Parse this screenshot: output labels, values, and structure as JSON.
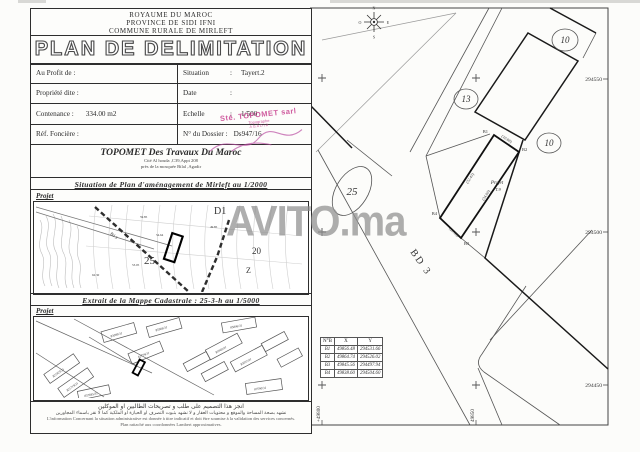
{
  "document": {
    "header": {
      "line1": "ROYAUME DU MAROC",
      "line2": "PROVINCE DE SIDI IFNI",
      "line3": "COMMUNE RURALE DE MIRLEFT"
    },
    "title": "PLAN DE DELIMITATION",
    "form": {
      "au_profit_label": "Au Profit de :",
      "propriete_label": "Propriété dite :",
      "contenance_label": "Contenance :",
      "contenance_value": "334.00 m2",
      "ref_fonciere_label": "Réf. Foncière :",
      "situation_label": "Situation",
      "situation_value": "Tayert.2",
      "date_label": "Date",
      "echelle_label": "Echelle",
      "echelle_value": "1/500",
      "dossier_label": "N° du Dossier :",
      "dossier_value": "Ds947/16",
      "colon": ":"
    },
    "firm": {
      "name": "TOPOMET Des Travaux Du Maroc",
      "address1": "Cité Al houda ,C39,Appt 208",
      "address2": "près de la mosquée Bilal ,Agadir"
    },
    "stamp": {
      "line1": "Sté. TOPOMET sarl",
      "line2": "Topographe",
      "line3": "AGADIR"
    },
    "sections": {
      "situation_title": "Situation de Plan d'aménagement de Mirleft au 1/2000",
      "cadastre_title": "Extrait de la Mappe Cadastrale : 25-3-h au 1/5000",
      "projet_label": "Projet"
    },
    "footer": {
      "arabic1": "انجز هذا التصميم على طلب و تصريحات الطالبين او الموكلين",
      "arabic2": "نشهد بصحة المساحة والموقع و محتويات العقار و لا نشهد بثبوت التصرف او الحيازة او الملكية كما لا نقر باسماء المجاورين",
      "french1": "L'information Concernant la situation administrative est donnée à titre indicatif et doit être soumise à la validation des services concernés.",
      "french2": "Plan rattaché aux coordonnées Lambert approximatives."
    }
  },
  "map1": {
    "labels": {
      "d1": "D1",
      "n25": "25",
      "n20": "20",
      "z": "Z",
      "bd": "Bd 3"
    },
    "elevations": [
      "59.85",
      "54.64",
      "53.05",
      "49.85",
      "62.30"
    ]
  },
  "map2": {
    "parcels": [
      "83099/31",
      "85966/31",
      "85806/31",
      "82779/31",
      "821925/31",
      "821719/31",
      "857845/31",
      "85969/31",
      "83097/31",
      "87590/31"
    ]
  },
  "plan": {
    "compass": {
      "n": "N",
      "s": "S",
      "e": "E",
      "o": "O"
    },
    "bd3_label": "BD 3",
    "circles": [
      "10",
      "13",
      "10",
      "25"
    ],
    "grid": {
      "y_labels": [
        "294550",
        "294500",
        "294450"
      ],
      "x_labels": [
        "+49800",
        "49850"
      ]
    },
    "parcel": {
      "name": "Projet",
      "lot": "T.9",
      "b1": "B1",
      "b2": "B2",
      "b3": "B3",
      "b4": "B4",
      "dim_top": "(10.00)",
      "dim_bottom": "(10.00)",
      "dim_left": "(32.43)",
      "dim_right": "(34.00)"
    },
    "table": {
      "headers": [
        "N°B",
        "X",
        "Y"
      ],
      "rows": [
        [
          "B1",
          "49856.48",
          "294531.66"
        ],
        [
          "B2",
          "49864.74",
          "294526.02"
        ],
        [
          "B3",
          "49845.56",
          "294497.94"
        ],
        [
          "B4",
          "49838.60",
          "294504.60"
        ]
      ]
    }
  },
  "watermark": "AVITO.ma",
  "colors": {
    "stamp": "#c8408f",
    "line": "#333333",
    "watermark": "#8f8f8f"
  }
}
